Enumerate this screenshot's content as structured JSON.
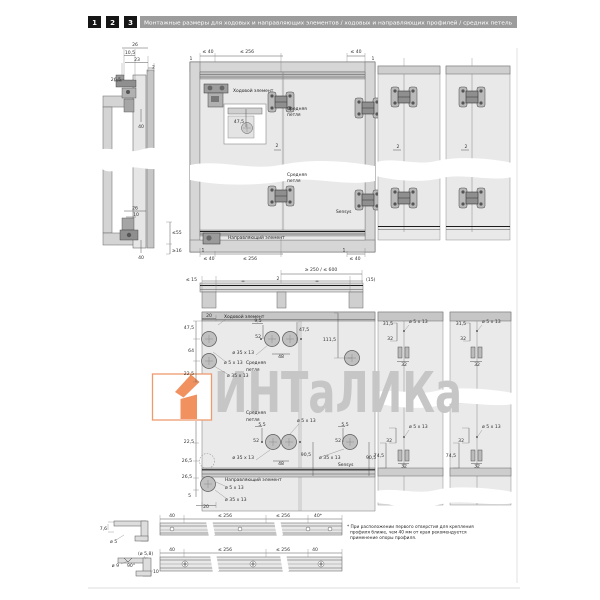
{
  "header": {
    "steps": [
      "1",
      "2",
      "3"
    ],
    "title": "Монтажные размеры для ходовых и направляющих элементов / ходовых и направляющих профилей / средних петель"
  },
  "labels": {
    "running_element": "Ходовой элемент",
    "middle_hinge_l1": "Средняя",
    "middle_hinge_l2": "петля",
    "sensys": "Sensys",
    "guide_element": "Направляющий элемент"
  },
  "dims": {
    "d26": "26",
    "d10_5": "10,5",
    "d23": "23",
    "d2": "2",
    "d26_5": "26,5",
    "d40": "40",
    "d10": "10",
    "le55": "≤55",
    "ge16": "≥16",
    "d1": "1",
    "le40": "≤ 40",
    "le256": "≤ 256",
    "le15": "≤ 15",
    "p15": "(15)",
    "eq": "=",
    "range": "≥ 250 / ≤ 600",
    "d47_5": "47,5",
    "d20": "20",
    "d64": "64",
    "d5": "5",
    "d22_5": "22,5",
    "d9_5": "9,5",
    "d5_5": "5,5",
    "d52": "52",
    "d48": "48",
    "d111_5": "111,5",
    "d90_5": "90,5",
    "hole5": "ø 5 x 13",
    "hole35": "ø 35 x 13",
    "d31_5": "31,5",
    "d32": "32",
    "d74_5": "74,5",
    "d7_6": "7,6",
    "dia5": "ø 5",
    "dia5_8": "(ø 5,8)",
    "dia9": "ø 9",
    "deg90": "90°",
    "d40star": "40*"
  },
  "footnote": {
    "l1": "* При расположении первого отверстия для крепления",
    "l2": "профиля ближе, чем 40 мм от края рекомендуется",
    "l3": "применение опоры профиля."
  },
  "watermark": {
    "text": "ИНТаЛИКа"
  },
  "colors": {
    "accent_orange": "#F0915F",
    "watermark_gray": "#C6C6C6",
    "header_bar": "#9C9C9C",
    "panel_gray": "#D6D6D6",
    "door_gray": "#E9E9E9"
  }
}
